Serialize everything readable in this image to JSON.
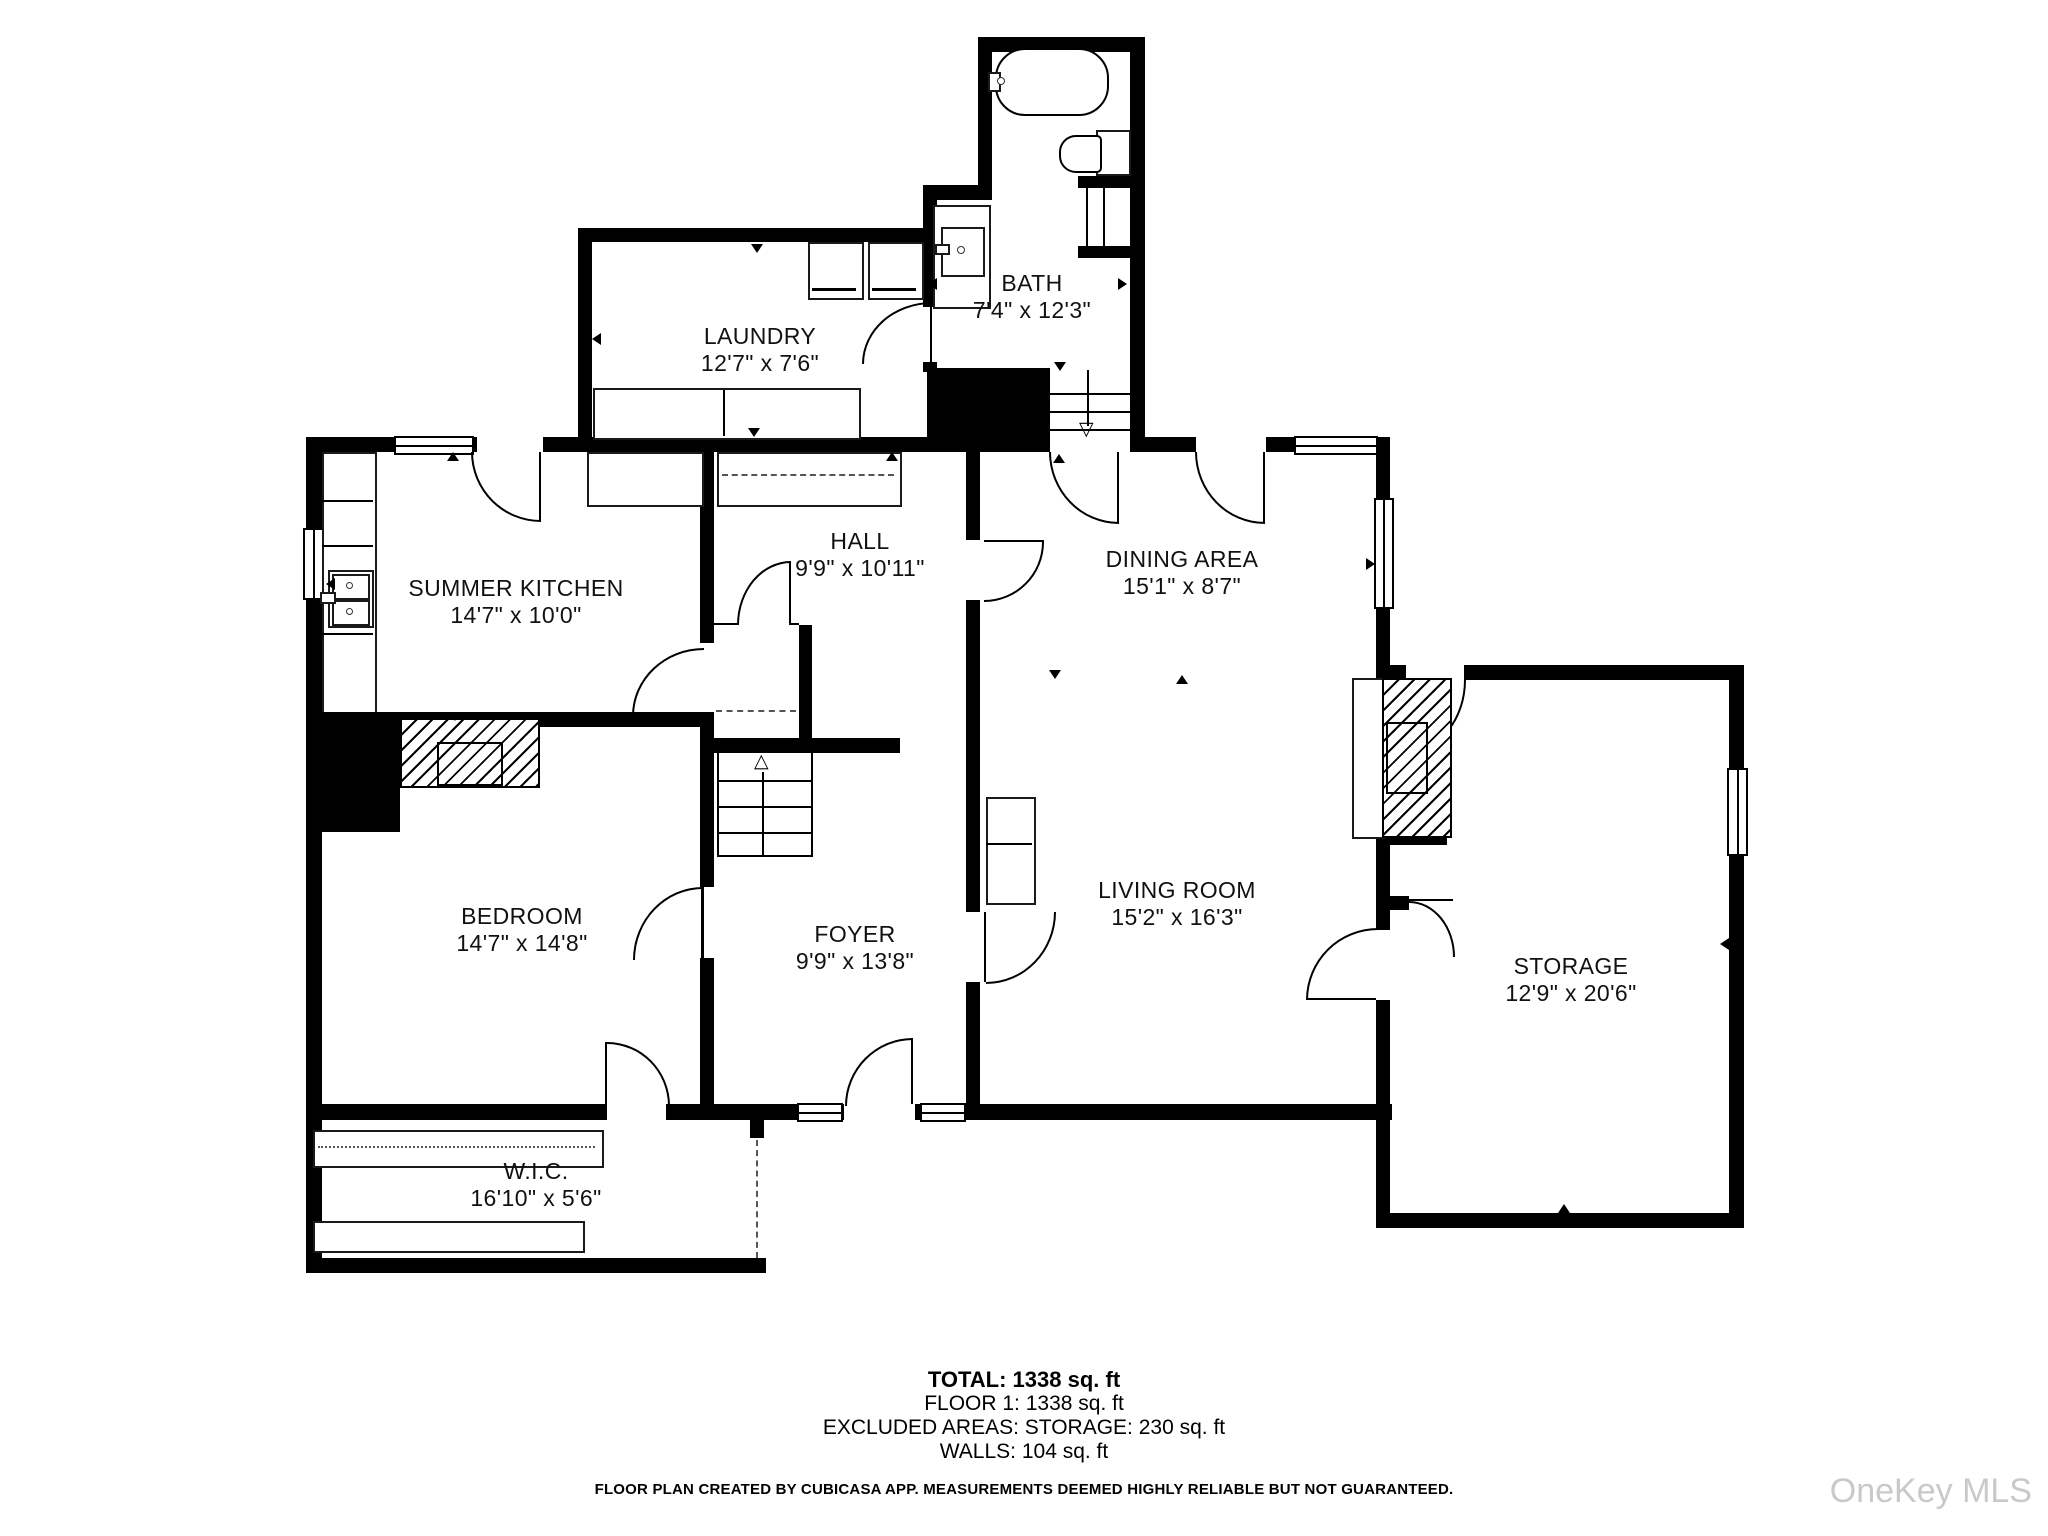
{
  "plan": {
    "rooms": [
      {
        "name": "SUMMER KITCHEN",
        "dims": "14'7\" x 10'0\""
      },
      {
        "name": "HALL",
        "dims": "9'9\" x 10'11\""
      },
      {
        "name": "DINING AREA",
        "dims": "15'1\" x 8'7\""
      },
      {
        "name": "LAUNDRY",
        "dims": "12'7\" x 7'6\""
      },
      {
        "name": "BATH",
        "dims": "7'4\" x 12'3\""
      },
      {
        "name": "BEDROOM",
        "dims": "14'7\" x 14'8\""
      },
      {
        "name": "FOYER",
        "dims": "9'9\" x 13'8\""
      },
      {
        "name": "LIVING ROOM",
        "dims": "15'2\" x 16'3\""
      },
      {
        "name": "STORAGE",
        "dims": "12'9\" x 20'6\""
      },
      {
        "name": "W.I.C.",
        "dims": "16'10\" x 5'6\""
      }
    ],
    "stair_up_icon": "△",
    "stair_down_icon": "▽"
  },
  "summary": {
    "total": "TOTAL: 1338 sq. ft",
    "floor": "FLOOR 1: 1338 sq. ft",
    "excluded": "EXCLUDED AREAS: STORAGE: 230 sq. ft",
    "walls": "WALLS: 104 sq. ft"
  },
  "disclaimer": "FLOOR PLAN CREATED BY CUBICASA APP. MEASUREMENTS DEEMED HIGHLY RELIABLE BUT NOT GUARANTEED.",
  "watermark": "OneKey MLS",
  "colors": {
    "wall": "#000000",
    "background": "#ffffff",
    "watermark": "#c9c9c9"
  }
}
